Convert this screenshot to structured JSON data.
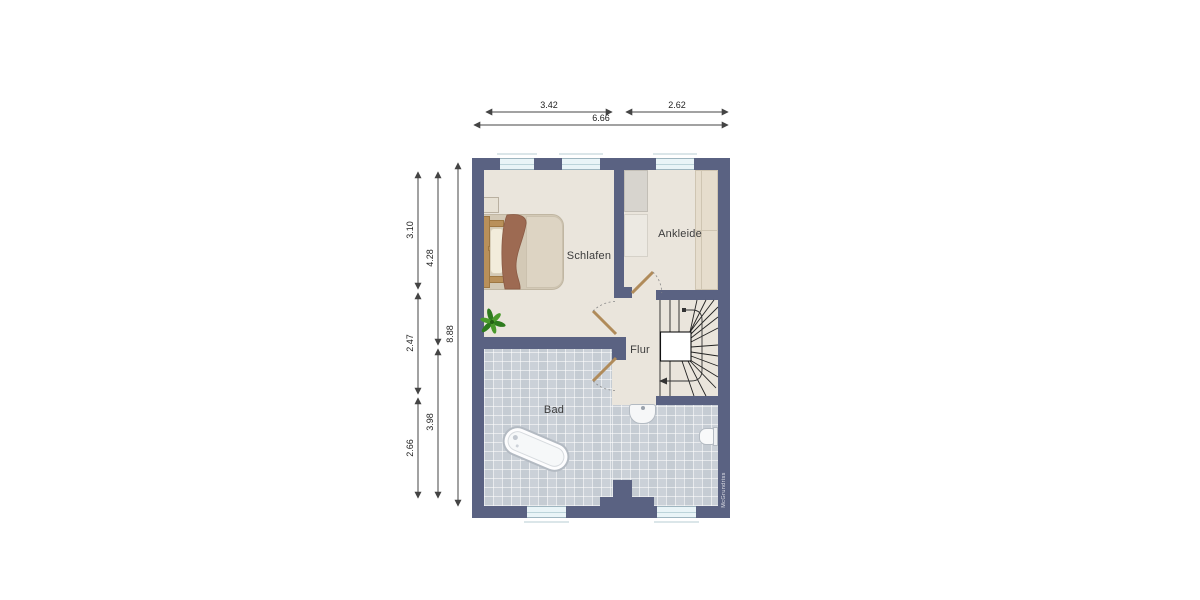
{
  "rooms": {
    "schlafen": "Schlafen",
    "ankleide": "Ankleide",
    "flur": "Flur",
    "bad": "Bad"
  },
  "dimensions": {
    "top_left": "3.42",
    "top_right": "2.62",
    "top_total": "6.66",
    "left_top": "3.10",
    "left_middle": "2.47",
    "left_bottom": "2.66",
    "inner_top": "4.28",
    "inner_bottom": "3.98",
    "left_total": "8.88"
  },
  "watermark": "McGrundriss",
  "colors": {
    "wall": "#5a6282",
    "floor": "#eae5dc",
    "tile": "#cbd1d8",
    "windowpane": "#e9f4f7",
    "door": "#b08b5a",
    "duvet": "#9d6a52",
    "wood": "#b9905a",
    "dim": "#444444",
    "label": "#3c3c3c"
  }
}
